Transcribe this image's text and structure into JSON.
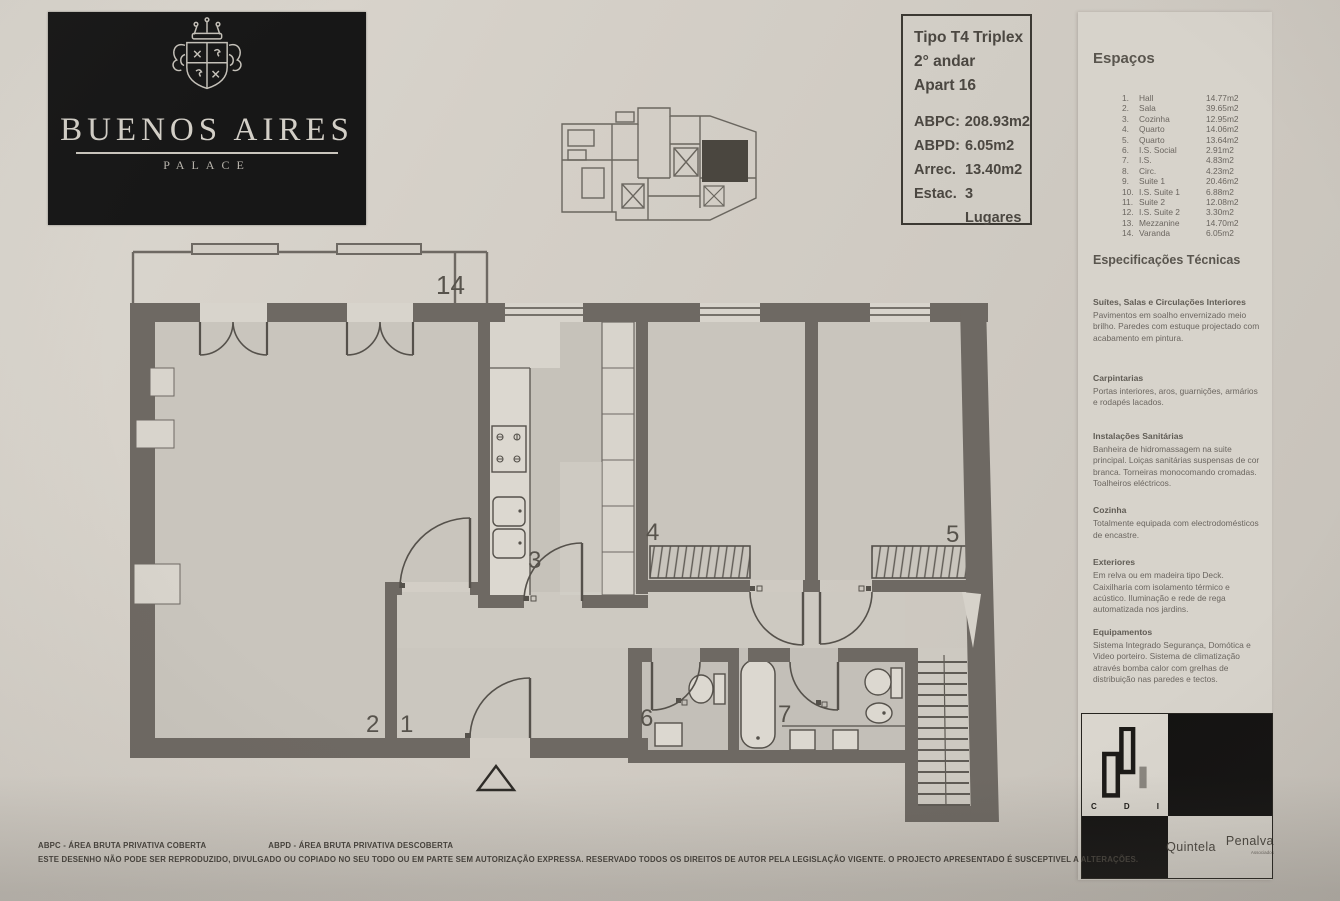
{
  "logo": {
    "title": "BUENOS AIRES",
    "subtitle": "PALACE"
  },
  "info_box": {
    "type": "Tipo T4 Triplex",
    "floor": "2° andar",
    "apartment": "Apart 16",
    "metrics": [
      {
        "label": "ABPC:",
        "value": "208.93m2"
      },
      {
        "label": "ABPD:",
        "value": "6.05m2"
      },
      {
        "label": "Arrec.",
        "value": "13.40m2"
      },
      {
        "label": "Estac.",
        "value": "3 Lugares"
      }
    ]
  },
  "espacos": {
    "title": "Espaços",
    "items": [
      {
        "num": "1.",
        "name": "Hall",
        "area": "14.77m2"
      },
      {
        "num": "2.",
        "name": "Sala",
        "area": "39.65m2"
      },
      {
        "num": "3.",
        "name": "Cozinha",
        "area": "12.95m2"
      },
      {
        "num": "4.",
        "name": "Quarto",
        "area": "14.06m2"
      },
      {
        "num": "5.",
        "name": "Quarto",
        "area": "13.64m2"
      },
      {
        "num": "6.",
        "name": "I.S. Social",
        "area": "2.91m2"
      },
      {
        "num": "7.",
        "name": "I.S.",
        "area": "4.83m2"
      },
      {
        "num": "8.",
        "name": "Circ.",
        "area": "4.23m2"
      },
      {
        "num": "9.",
        "name": "Suite 1",
        "area": "20.46m2"
      },
      {
        "num": "10.",
        "name": "I.S. Suite 1",
        "area": "6.88m2"
      },
      {
        "num": "11.",
        "name": "Suite 2",
        "area": "12.08m2"
      },
      {
        "num": "12.",
        "name": "I.S. Suite 2",
        "area": "3.30m2"
      },
      {
        "num": "13.",
        "name": "Mezzanine",
        "area": "14.70m2"
      },
      {
        "num": "14.",
        "name": "Varanda",
        "area": "6.05m2"
      }
    ]
  },
  "specs": {
    "title": "Especificações Técnicas",
    "sections": [
      {
        "heading": "Suítes, Salas e Circulações Interiores",
        "body": "Pavimentos em soalho envernizado meio brilho. Paredes com estuque projectado com acabamento em pintura."
      },
      {
        "heading": "Carpintarias",
        "body": "Portas interiores, aros, guarnições, armários e rodapés lacados."
      },
      {
        "heading": "Instalações Sanitárias",
        "body": "Banheira de hidromassagem na suite principal. Loiças sanitárias suspensas de cor branca. Torneiras monocomando cromadas. Toalheiros eléctricos."
      },
      {
        "heading": "Cozinha",
        "body": "Totalmente equipada com electrodomésticos de encastre."
      },
      {
        "heading": "Exteriores",
        "body": "Em relva ou em madeira tipo Deck. Caixilharia com isolamento térmico e acústico. Iluminação e rede de rega automatizada nos jardins."
      },
      {
        "heading": "Equipamentos",
        "body": "Sistema Integrado Segurança, Domótica e Video porteiro. Sistema de climatização através bomba calor com grelhas de distribuição nas paredes e tectos."
      }
    ]
  },
  "plan": {
    "rooms": {
      "r1": "1",
      "r2": "2",
      "r3": "3",
      "r4": "4",
      "r5": "5",
      "r6": "6",
      "r7": "7",
      "r14": "14"
    }
  },
  "footer": {
    "abpc": "ABPC - ÁREA BRUTA PRIVATIVA COBERTA",
    "abpd": "ABPD - ÁREA BRUTA PRIVATIVA DESCOBERTA",
    "disclaimer": "ESTE DESENHO NÃO PODE SER REPRODUZIDO, DIVULGADO OU COPIADO NO SEU TODO OU EM PARTE SEM AUTORIZAÇÃO EXPRESSA. RESERVADO TODOS OS DIREITOS DE AUTOR PELA LEGISLAÇÃO VIGENTE. O PROJECTO APRESENTADO É SUSCEPTIVEL A ALTERAÇÕES."
  },
  "branding": {
    "cdi": {
      "c": "C",
      "d": "D",
      "i": "I"
    },
    "quintela": "Quintela",
    "penalva": "Penalva",
    "sub": "Associados"
  },
  "colors": {
    "paper": "#d2cdc5",
    "wall": "#6e6963",
    "ink": "#4b4741",
    "logo_bg": "#171717"
  }
}
